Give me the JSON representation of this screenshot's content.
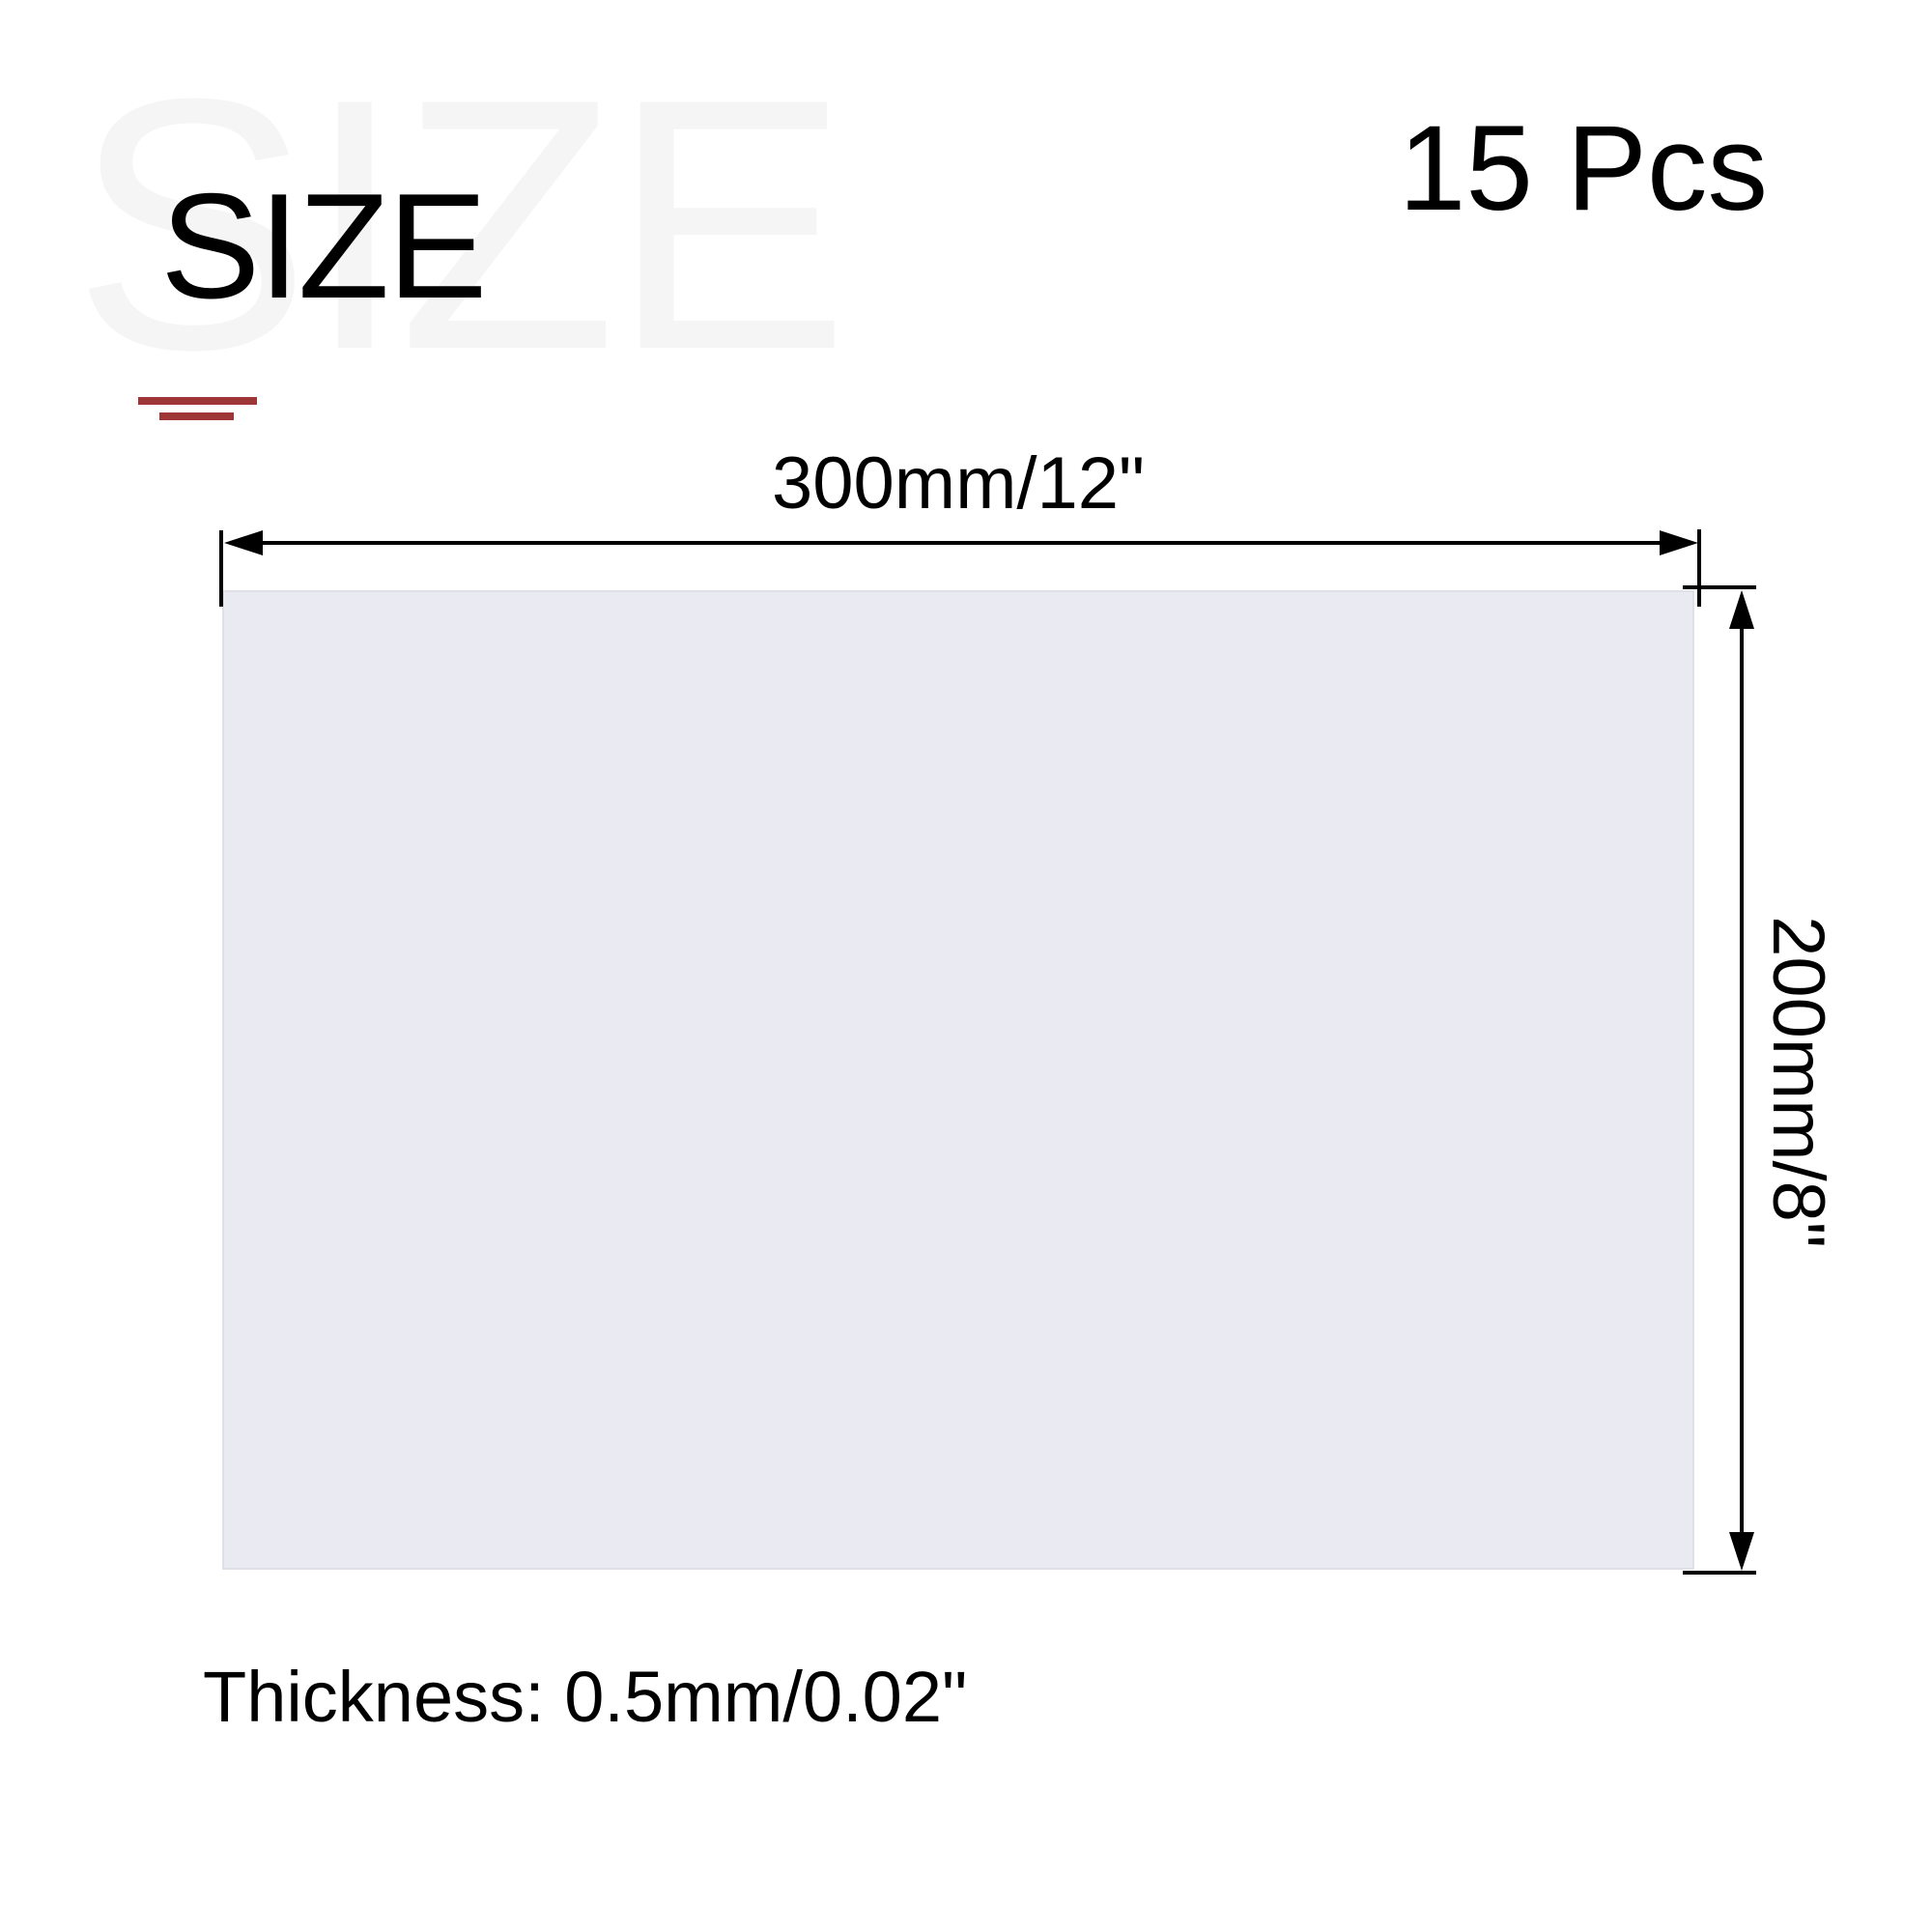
{
  "title": {
    "main": "SIZE",
    "watermark": "SIZE"
  },
  "count_label": "15 Pcs",
  "diagram": {
    "width_label": "300mm/12\"",
    "height_label": "200mm/8\"",
    "thickness_label": "Thickness: 0.5mm/0.02\""
  },
  "colors": {
    "accent_red": "#9e3536",
    "panel_fill": "#eaeaf2",
    "panel_border": "#dfdfe8",
    "watermark_gray": "#f5f5f5",
    "dimension_line_black": "#000000",
    "background": "#ffffff"
  }
}
